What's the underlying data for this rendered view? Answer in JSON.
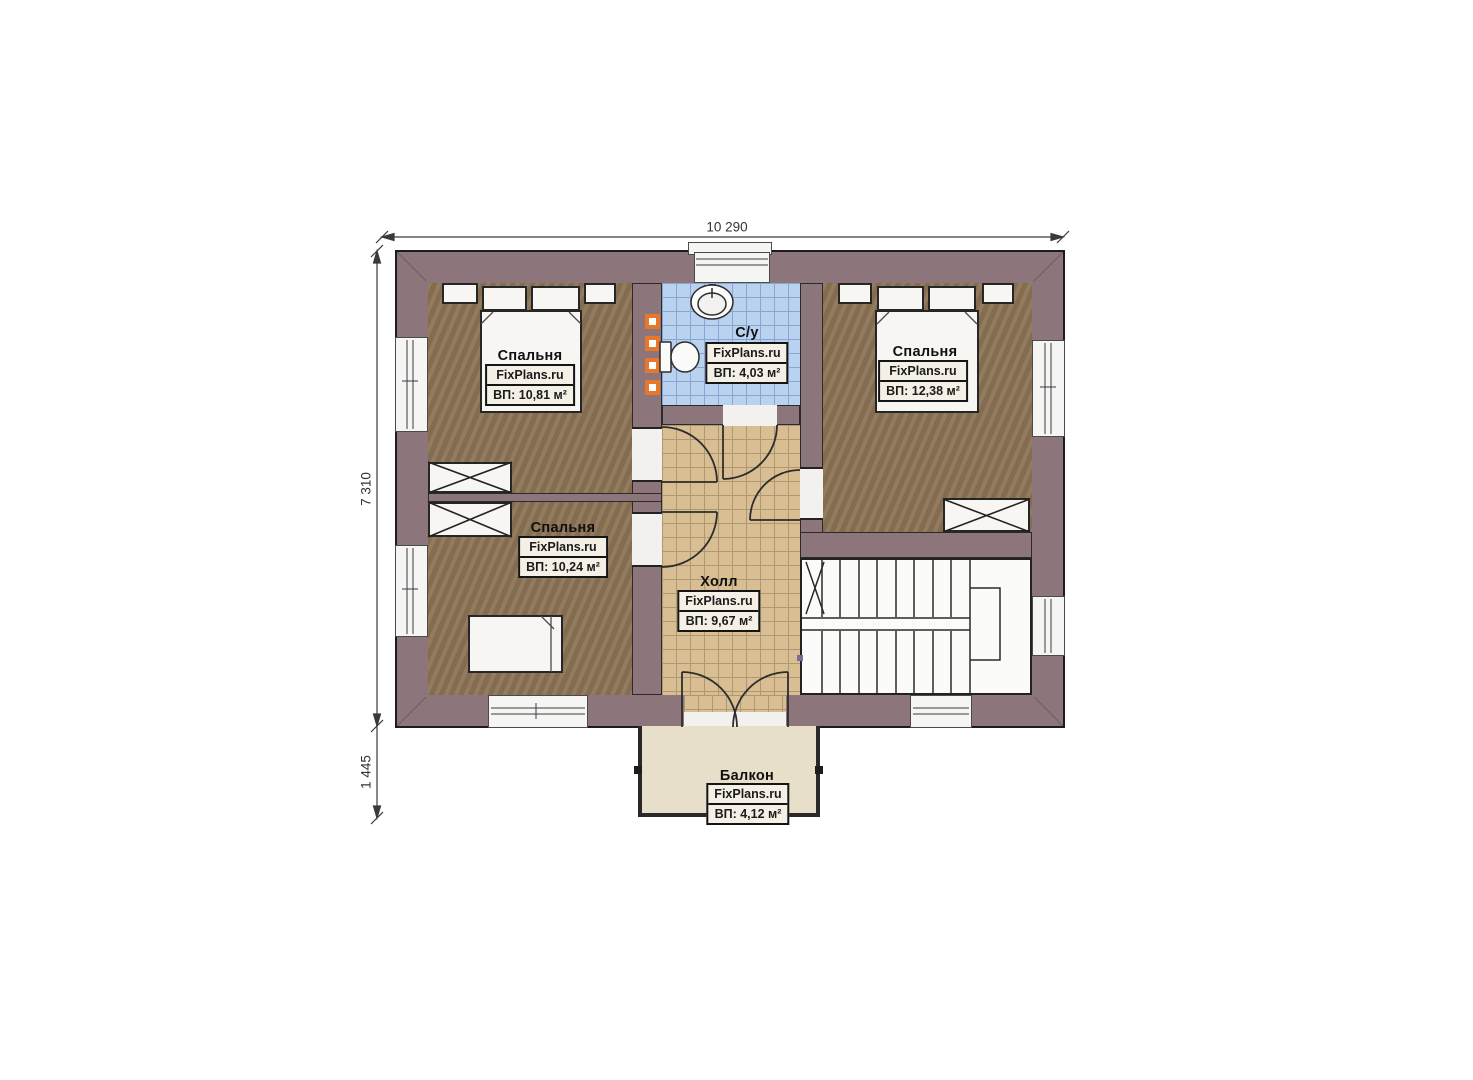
{
  "plan": {
    "type": "floor-plan",
    "watermark_site": "FixPlans.ru"
  },
  "dimensions": {
    "width_label": "10 290",
    "height_label": "7 310",
    "balcony_height_label": "1 445"
  },
  "rooms": [
    {
      "id": "bedroom-top-left",
      "name": "Спальня",
      "watermark": "FixPlans.ru",
      "area": "ВП: 10,81 м²"
    },
    {
      "id": "bathroom",
      "name": "С/у",
      "watermark": "FixPlans.ru",
      "area": "ВП: 4,03 м²"
    },
    {
      "id": "bedroom-top-right",
      "name": "Спальня",
      "watermark": "FixPlans.ru",
      "area": "ВП: 12,38 м²"
    },
    {
      "id": "bedroom-bottom-left",
      "name": "Спальня",
      "watermark": "FixPlans.ru",
      "area": "ВП: 10,24 м²"
    },
    {
      "id": "hall",
      "name": "Холл",
      "watermark": "FixPlans.ru",
      "area": "ВП: 9,67 м²"
    },
    {
      "id": "balcony",
      "name": "Балкон",
      "watermark": "FixPlans.ru",
      "area": "ВП: 4,12 м²"
    }
  ],
  "colors": {
    "wall": "#8d767b",
    "wall_outline": "#1c1c1c",
    "bedroom_floor": "#8b7355",
    "bathroom_tile": "#b8d2f0",
    "bathroom_tile_grid": "#88a6cf",
    "hall_tile": "#d8be92",
    "hall_tile_grid": "#ae9870",
    "balcony_floor": "#e8dfca",
    "stairs_white": "#fbfbfa",
    "towel_rail_orange": "#e8772e",
    "label_box_bg": "#f4f0e5"
  }
}
